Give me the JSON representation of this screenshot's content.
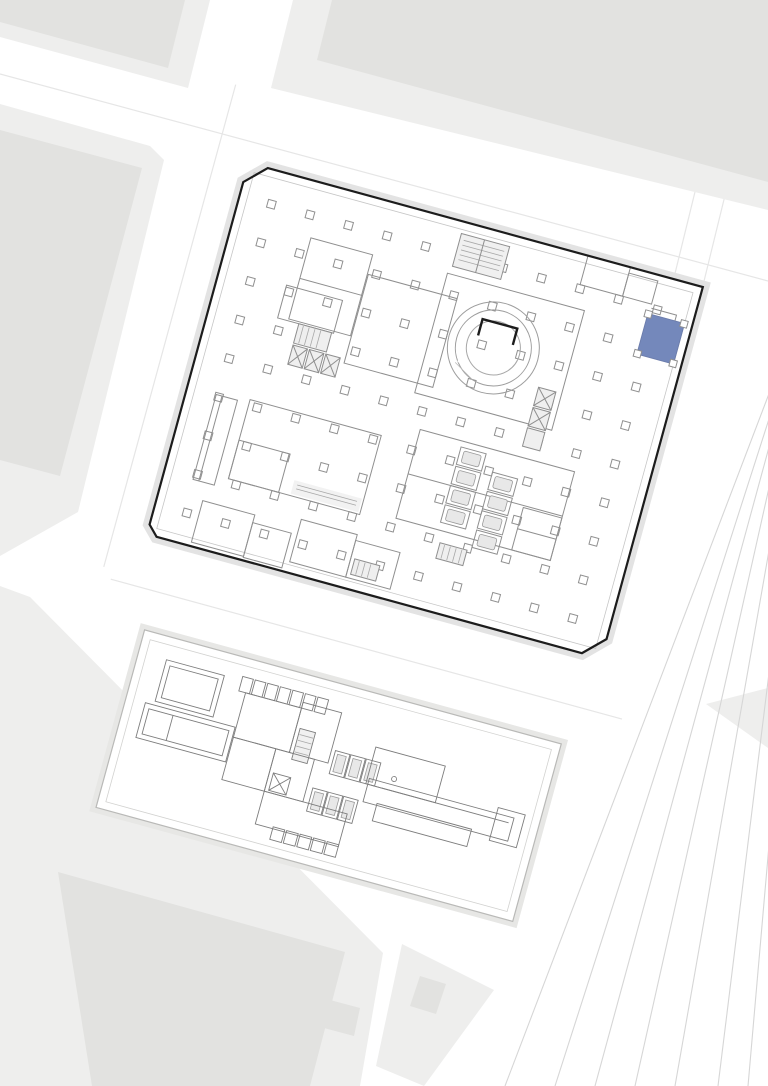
{
  "document": {
    "kind": "architectural-site-plan",
    "visible_text": "",
    "structure": {
      "upper_plan": "large-floor-plan-with-circular-ramp-core",
      "lower_plan": "podium-plan-on-plinth",
      "context": "city-blocks-streets-and-rail-fan"
    },
    "highlighted_room_count": 1
  },
  "colors": {
    "background": "#ffffff",
    "highlight": "#7488BB",
    "highlight_stroke": "#6b7cab",
    "block_core": "#e2e2e0",
    "block_halo": "#eeeeed",
    "outline": "#1c1c1c",
    "wall": "#8f8f8f",
    "podium_wall": "#7d7d7d",
    "shadow": "#e3e3e3",
    "plinth_edge": "#b9b9b7",
    "rail": "#d6d6d6",
    "service_fill": "#ececec"
  }
}
